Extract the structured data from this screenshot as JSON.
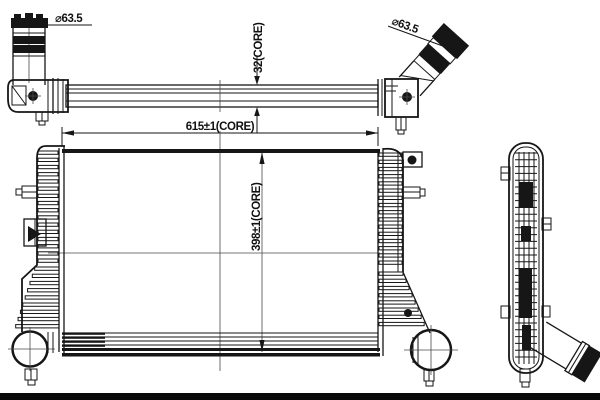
{
  "drawing": {
    "type": "technical-drawing",
    "subject": "intercooler / charge air cooler, three orthographic views",
    "labels": {
      "left_pipe_diameter": "⌀63.5",
      "right_pipe_diameter": "⌀63.5",
      "core_depth": "32(CORE)",
      "core_width": "615±1(CORE)",
      "core_height": "398±1(CORE)"
    },
    "colors": {
      "line": "#161616",
      "background": "#ffffff",
      "watermark_bar": "#0a0a0a"
    }
  }
}
